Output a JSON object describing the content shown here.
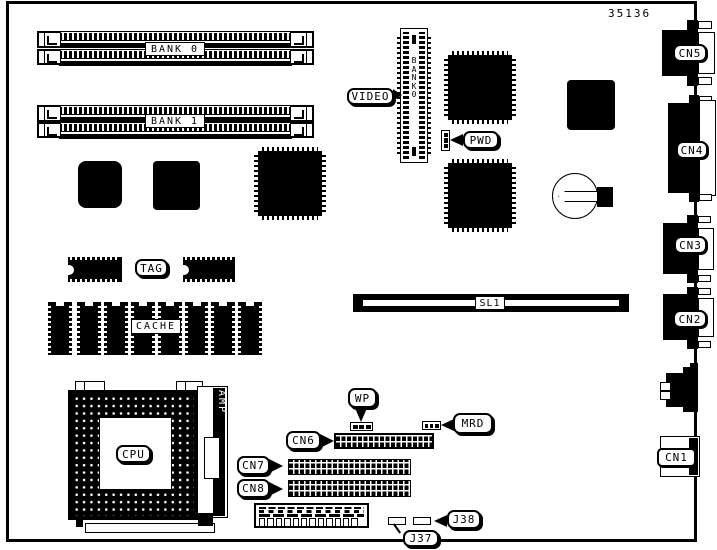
{
  "figure": {
    "part_number": "35136"
  },
  "labels": {
    "bank0": "BANK 0",
    "bank1": "BANK 1",
    "video": "VIDEO",
    "video_slot_vertical": "BANK0",
    "pwd": "PWD",
    "tag": "TAG",
    "cache": "CACHE",
    "sl1": "SL1",
    "cpu": "CPU",
    "amp": "AMP",
    "wp": "WP",
    "mrd": "MRD",
    "cn6": "CN6",
    "cn7": "CN7",
    "cn8": "CN8",
    "j37": "J37",
    "j38": "J38",
    "cn5": "CN5",
    "cn4": "CN4",
    "cn3": "CN3",
    "cn2": "CN2",
    "cn1": "CN1"
  },
  "colors": {
    "ink": "#000000",
    "background": "#ffffff"
  }
}
